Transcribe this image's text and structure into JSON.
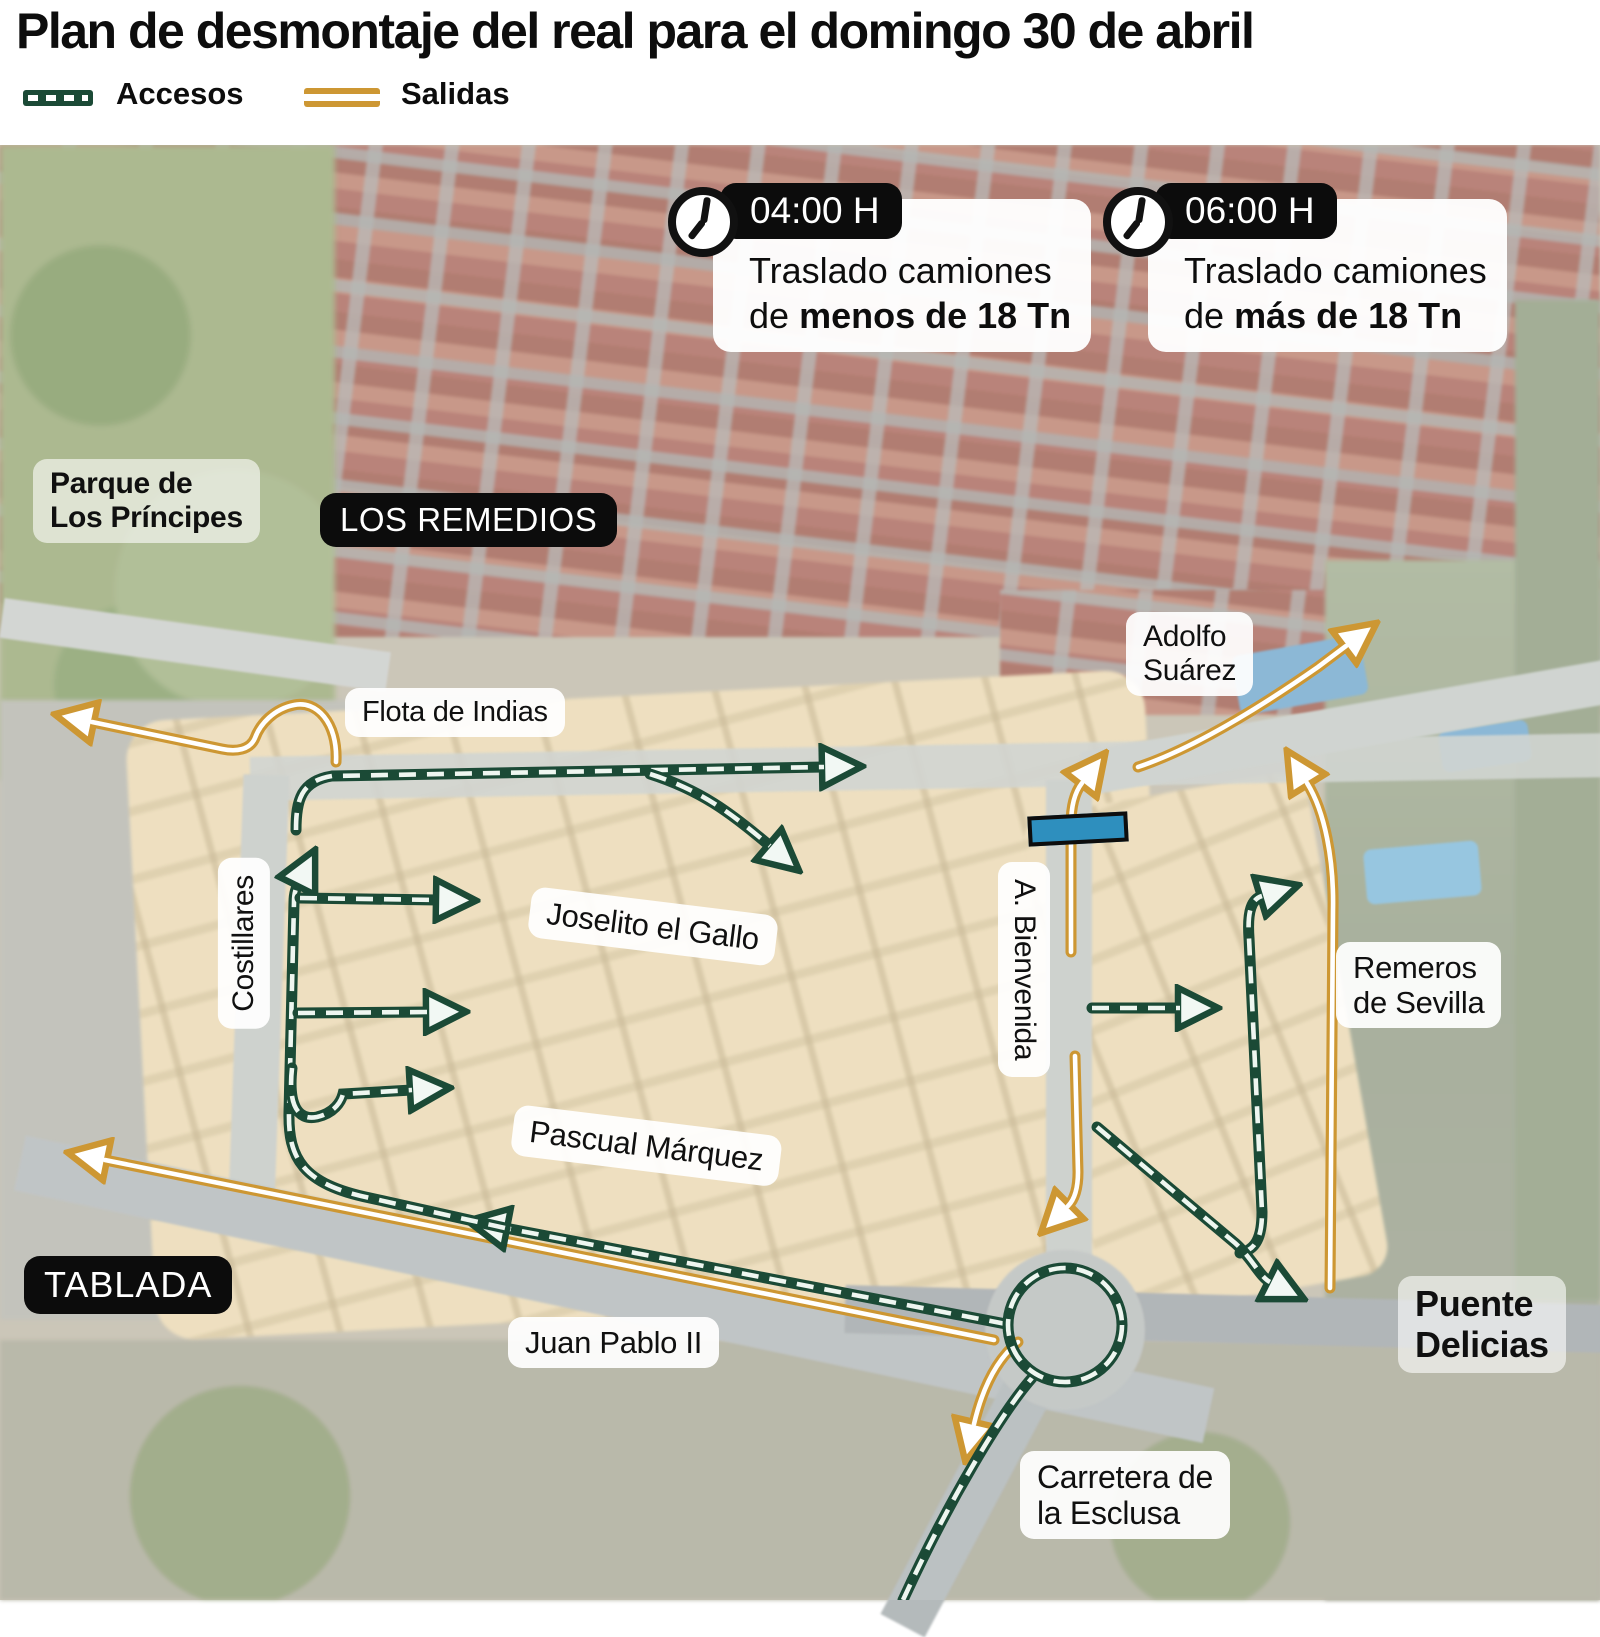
{
  "title": "Plan de desmontaje del real para el domingo 30 de abril",
  "legend": {
    "accesos_label": "Accesos",
    "salidas_label": "Salidas"
  },
  "colors": {
    "accesos_green": "#1b4a36",
    "salidas_orange": "#cd9733",
    "badge_black": "#0c0c0c",
    "closure_blue": "#2e8fbe"
  },
  "callouts": [
    {
      "time": "04:00 H",
      "line1": "Traslado camiones",
      "line2_prefix": "de",
      "line2_bold": "menos de 18 Tn"
    },
    {
      "time": "06:00 H",
      "line1": "Traslado camiones",
      "line2_prefix": "de",
      "line2_bold": "más de 18 Tn"
    }
  ],
  "labels": {
    "parque_line1": "Parque de",
    "parque_line2": "Los Príncipes",
    "los_remedios": "LOS REMEDIOS",
    "flota": "Flota de Indias",
    "adolfo_line1": "Adolfo",
    "adolfo_line2": "Suárez",
    "costillares": "Costillares",
    "joselito": "Joselito el Gallo",
    "bienvenida": "A. Bienvenida",
    "pascual": "Pascual Márquez",
    "remeros_line1": "Remeros",
    "remeros_line2": "de Sevilla",
    "tablada": "TABLADA",
    "juan_pablo": "Juan Pablo II",
    "puente_line1": "Puente",
    "puente_line2": "Delicias",
    "carretera_line1": "Carretera de",
    "carretera_line2": "la Esclusa"
  }
}
